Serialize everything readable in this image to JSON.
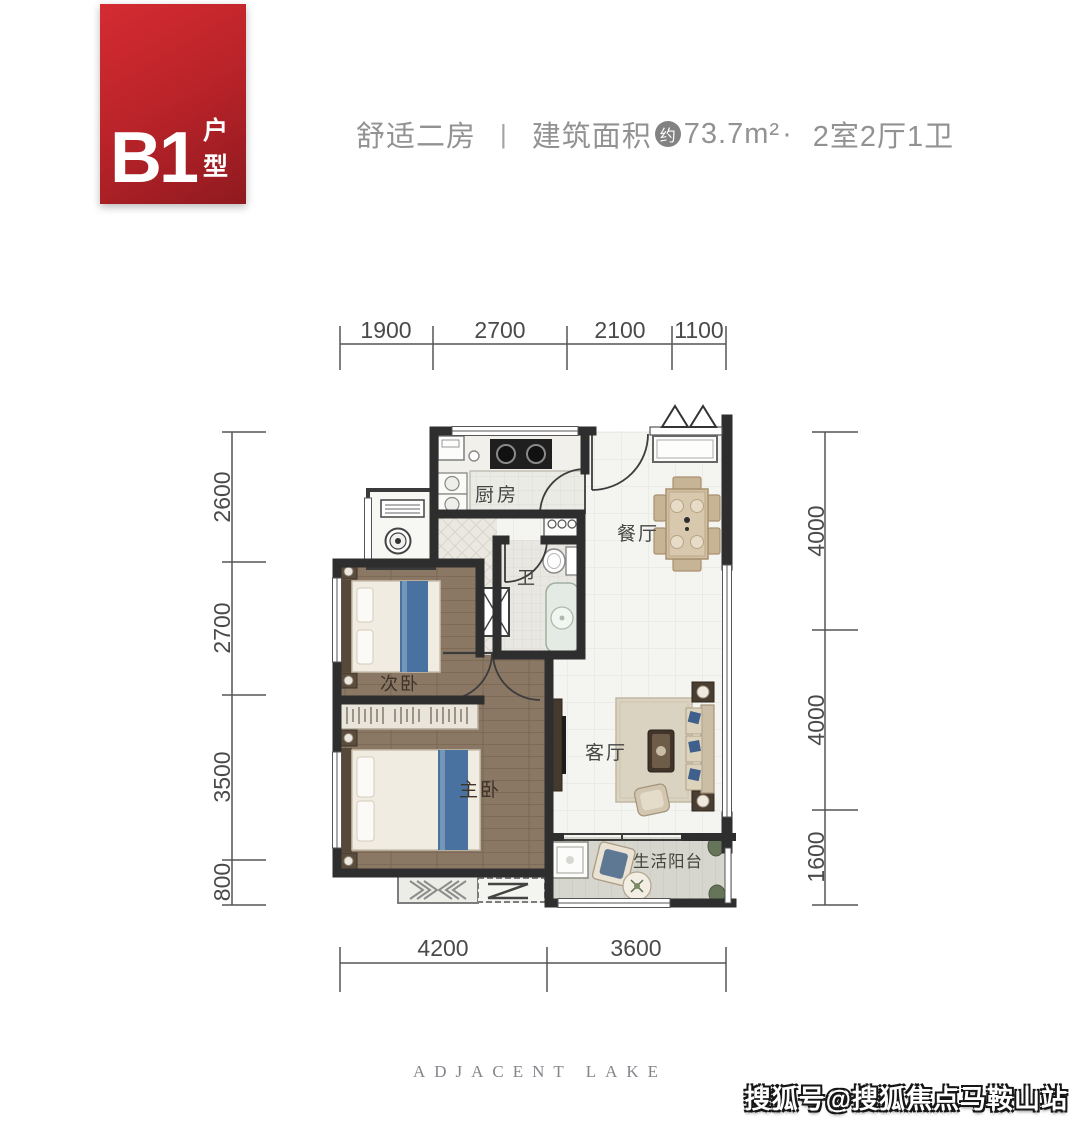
{
  "badge": {
    "code": "B1",
    "label": "户型"
  },
  "header": {
    "subtitle": "舒适二房",
    "divider": "|",
    "area_label": "建筑面积",
    "area_approx": "约",
    "area_value": "73.7m²",
    "separator": "·",
    "layout": "2室2厅1卫"
  },
  "plan": {
    "rooms": {
      "kitchen": "厨房",
      "bath": "卫",
      "dining": "餐厅",
      "living": "客厅",
      "second_bedroom": "次卧",
      "master_bedroom": "主卧",
      "balcony": "生活阳台"
    },
    "dims": {
      "top": [
        "1900",
        "2700",
        "2100",
        "1100"
      ],
      "left": [
        "2600",
        "2700",
        "3500",
        "800"
      ],
      "right": [
        "4000",
        "4000",
        "1600"
      ],
      "bottom": [
        "4200",
        "3600"
      ]
    }
  },
  "footer": {
    "brand": "ADJACENT  LAKE",
    "watermark": "搜狐号@搜狐焦点马鞍山站"
  },
  "colors": {
    "badge_red": "#b92329",
    "wall": "#2e2e2e",
    "wood_floor": "#8a7764",
    "bed_blue": "#4a72a0",
    "tile": "#f4f4f1",
    "title_text": "#929292",
    "dim_text": "#4a4a4a"
  }
}
